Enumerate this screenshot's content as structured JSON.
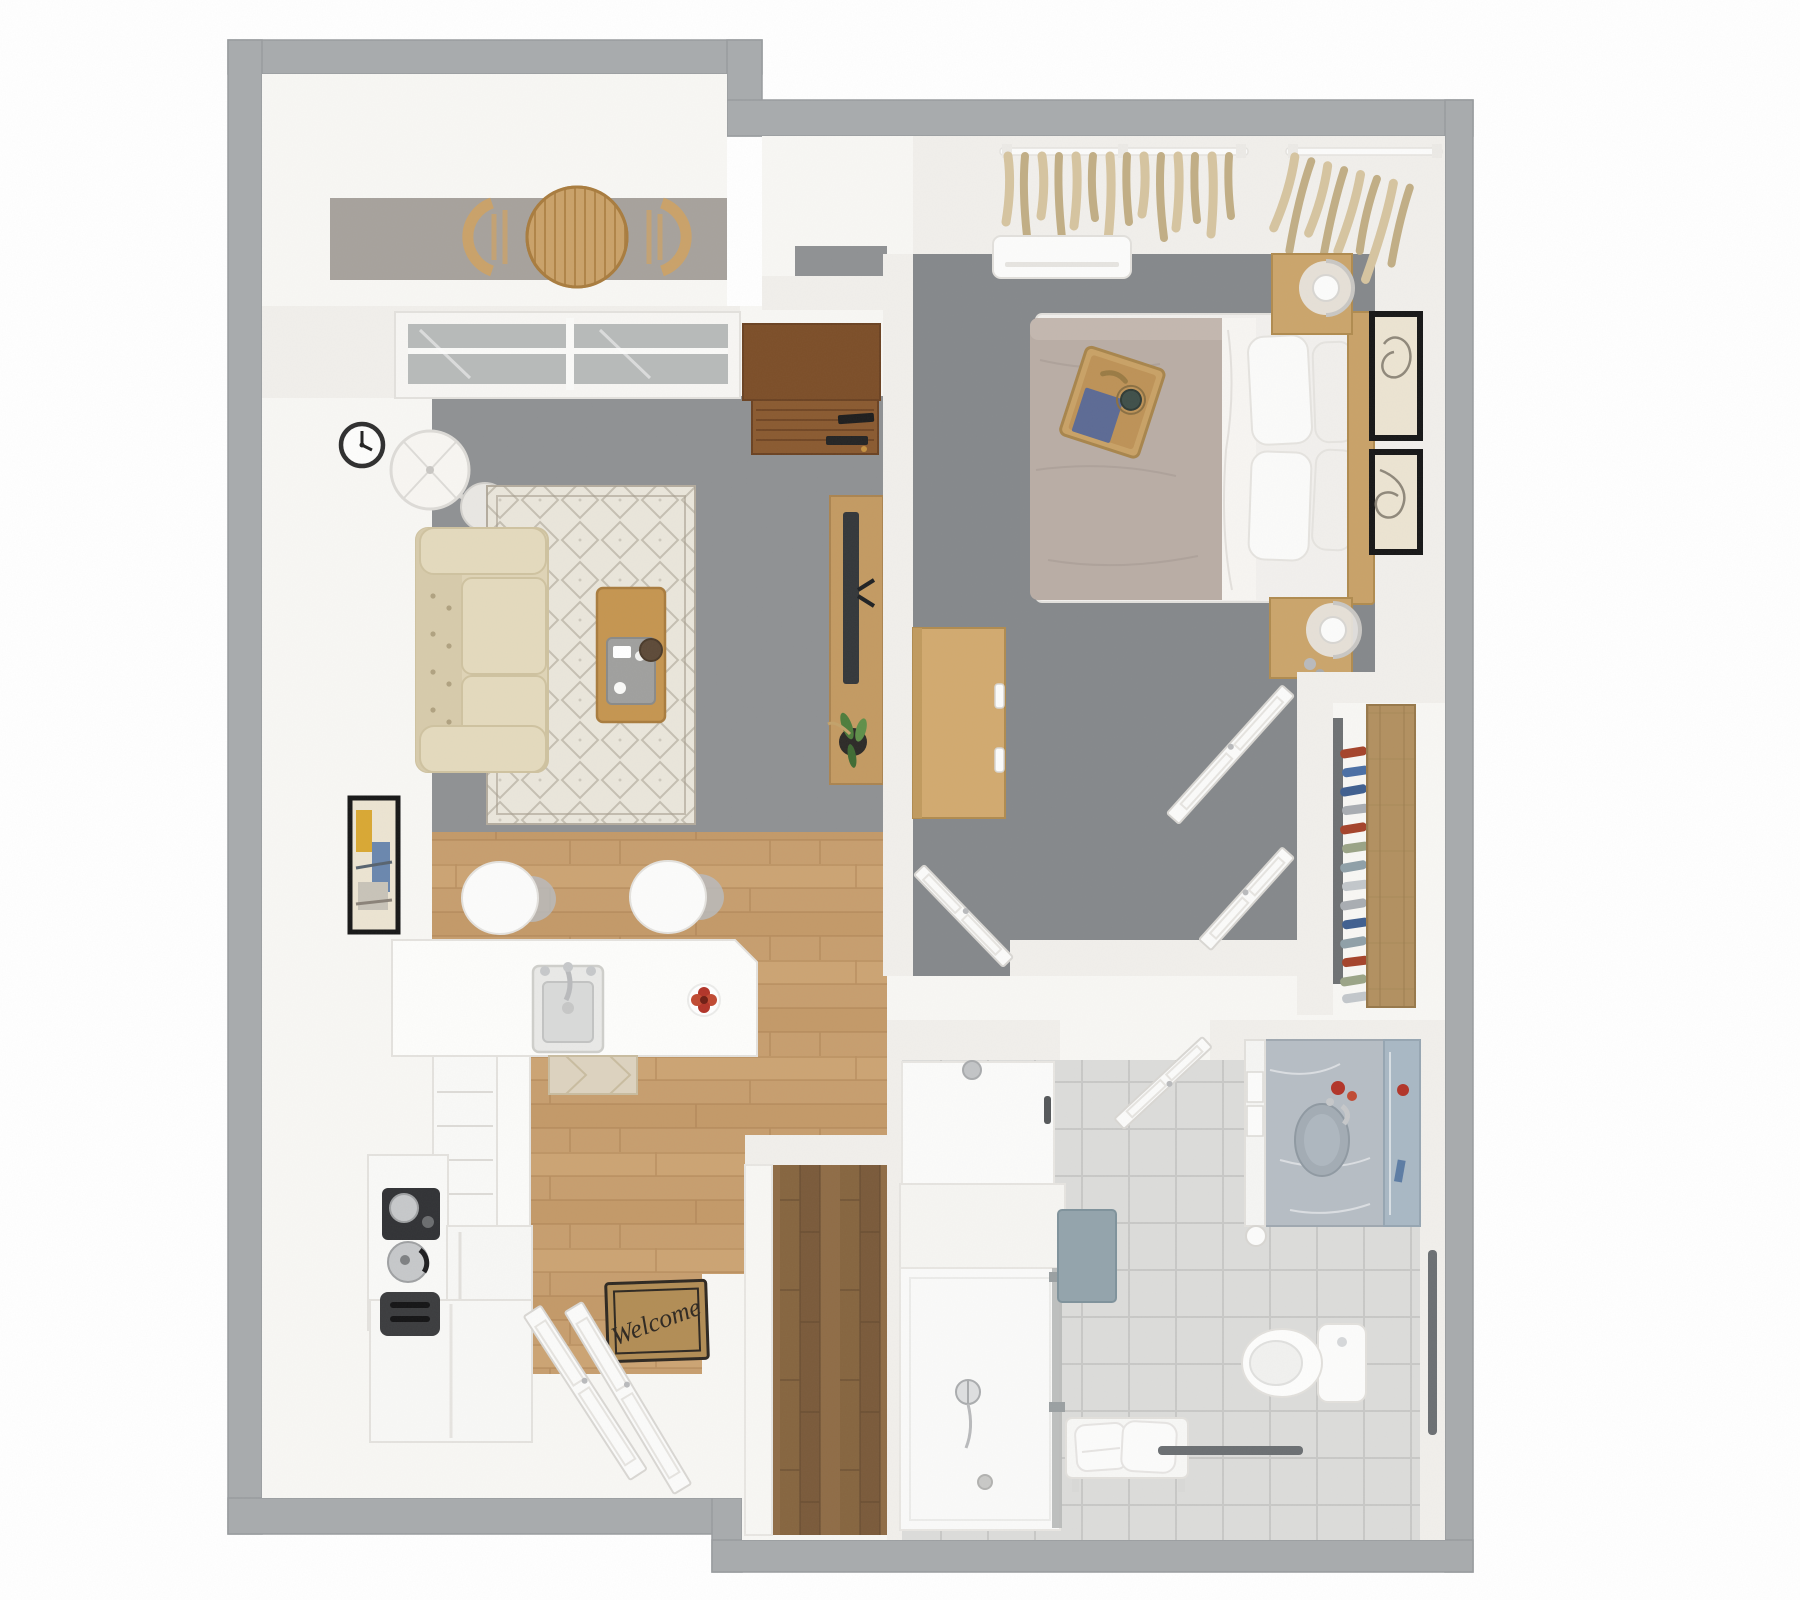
{
  "scene": {
    "type": "3d-rendered-floor-plan-top-view",
    "unit": "one-bedroom apartment",
    "doormat_text": "Welcome"
  },
  "rooms": [
    {
      "name": "balcony",
      "furniture": [
        "round-slat-table",
        "curved-chair-left",
        "curved-chair-right",
        "concrete-floor"
      ]
    },
    {
      "name": "living-room",
      "furniture": [
        "sliding-glass-door",
        "wall-clock",
        "floor-lamp",
        "tufted-sofa",
        "area-rug",
        "coffee-table-with-tray",
        "media-shelf",
        "tv-console",
        "tv",
        "potted-plant",
        "wall-art"
      ]
    },
    {
      "name": "kitchen",
      "furniture": [
        "l-shaped-island",
        "sink",
        "faucet",
        "bar-stool",
        "bar-stool",
        "flower-dish",
        "kitchen-mat",
        "drawer-cabinet",
        "refrigerator",
        "base-cabinet",
        "coffee-maker",
        "kettle",
        "toaster",
        "welcome-mat",
        "entry-double-doors"
      ]
    },
    {
      "name": "bedroom",
      "furniture": [
        "curtained-window",
        "curtained-window",
        "ac-unit",
        "double-bed",
        "pillows",
        "bed-tray-with-book-and-cup",
        "headboard",
        "nightstand-north",
        "table-lamp",
        "nightstand-south",
        "table-lamp",
        "dresser-desk",
        "framed-art",
        "framed-art",
        "open-door"
      ]
    },
    {
      "name": "closet",
      "furniture": [
        "wood-shelf-panel",
        "folded-clothes-stack",
        "double-doors"
      ]
    },
    {
      "name": "bathroom",
      "furniture": [
        "open-door",
        "shower-upper-pan",
        "shower-ledge",
        "shower-lower-pan",
        "glass-panel",
        "shower-fixture",
        "bath-mat",
        "vanity-counter",
        "vanity-sink",
        "mirror-strip",
        "toilet",
        "toilet-paper-holder",
        "bench-with-towels",
        "grab-bar",
        "towel-bar"
      ]
    },
    {
      "name": "entry-closet",
      "furniture": [
        "white-ledge",
        "dark-wood-floor"
      ]
    }
  ],
  "palette": {
    "wall_outer": "#a8abad",
    "wall_outer_edge": "#989b9e",
    "wall_inner": "#f1efeb",
    "floor_white": "#f8f7f4",
    "carpet_living": "#8f9193",
    "carpet_bedroom": "#85888b",
    "concrete": "#a7a29c",
    "wood_floor": "#c79e6e",
    "wood_floor_dark": "#a87c4e",
    "wood_floor_light": "#d2aa7a",
    "wood_floor_mid": "#bf9462",
    "wood_dark1": "#86653f",
    "wood_dark2": "#7a5a3a",
    "wood_dark3": "#8f6c46",
    "wood_dark_line": "#5f452c",
    "shelf_wood": "#b29060",
    "shelf_wood_line": "#97784a",
    "closet_back": "#6e7173",
    "rug_base": "#eae6db",
    "rug_line": "#a69e90",
    "rug_border": "#b4ac9e",
    "sofa_base": "#dfd4b6",
    "sofa_dark": "#d7cbab",
    "sofa_light": "#e4dabd",
    "sofa_line": "#cfc2a0",
    "sofa_btn": "#b0a280",
    "table_wood": "#c59550",
    "table_wood_dark": "#a97c3e",
    "table_top": "#caa269",
    "tray_gray": "#a0a09e",
    "media_dark": "#7c4e28",
    "media_dark2": "#8a5a30",
    "media_line": "#6b4222",
    "console_wood": "#c39a62",
    "console_line": "#ab8450",
    "tv": "#34373a",
    "tv_dark": "#1f2123",
    "plant_pot": "#2c2a27",
    "leaf1": "#4e7d3c",
    "leaf2": "#5f8f49",
    "leaf3": "#3f6b33",
    "stem": "#c2a26a",
    "glass": "#b7bab9",
    "track_white": "#fafaf8",
    "frame_white": "#f7f6f3",
    "frame_edge": "#e3e1dd",
    "duvet": "#b9ada5",
    "duvet_line": "#a79b92",
    "duvet_light": "#c4b8b0",
    "sheet": "#f7f5f2",
    "mattress": "#f2f0ed",
    "pillow": "#fbfbfa",
    "pillow_back": "#f1efec",
    "pillow_line": "#e5e3df",
    "bed_wood": "#c9a268",
    "bed_wood_line": "#b08b4f",
    "nstand": "#cba56b",
    "tray_wood": "#c9a266",
    "tray_wood_line": "#a8854c",
    "tray_in": "#bd9257",
    "book_blue": "#5c6a94",
    "cup_green": "#3f4f49",
    "curtain": "#d6c4a0",
    "curtain_dark": "#c1ae85",
    "art_cream": "#ece4d2",
    "frame_black": "#171717",
    "art_line": "#8f887a",
    "white_goods": "#fcfcfb",
    "white_edge": "#e4e2de",
    "lamp_shade": "#f8f6f2",
    "lamp_ring": "#dddbd7",
    "lamp_base": "#e9e7e3",
    "metal": "#c6c8ca",
    "metal_mid": "#b9babc",
    "metal_dark": "#6b6f72",
    "appl_dark": "#313235",
    "appl_dark2": "#3b3c3e",
    "tile": "#dcdcda",
    "grout": "#c8c8c6",
    "shower": "#fbfbfa",
    "shower_edge": "#e8e6e2",
    "marble": "#b6bdc4",
    "marble_edge": "#9fa8b0",
    "sink_bowl": "#a3acb4",
    "mirror": "#a9b8c4",
    "mat_blue": "#93a4ac",
    "mat_blue_edge": "#7f929b",
    "red": "#b23428",
    "red2": "#c04a32",
    "mat_tan": "#b28d55",
    "mat_text": "#2e2821",
    "door_white": "#fbfbfa",
    "door_edge": "#d9d7d3",
    "door_line": "#e6e4e0",
    "kmat": "#ddd3bf",
    "kmat_line": "#c9bca0",
    "clock_ring": "#2e2e2e",
    "clothes1": "#a5432a",
    "clothes2": "#4a6fa5",
    "clothes3": "#3f5f8f",
    "clothes4": "#a9adb2",
    "clothes5": "#9aa486",
    "clothes6": "#8fa0a8",
    "clothes7": "#c2c7cb"
  }
}
